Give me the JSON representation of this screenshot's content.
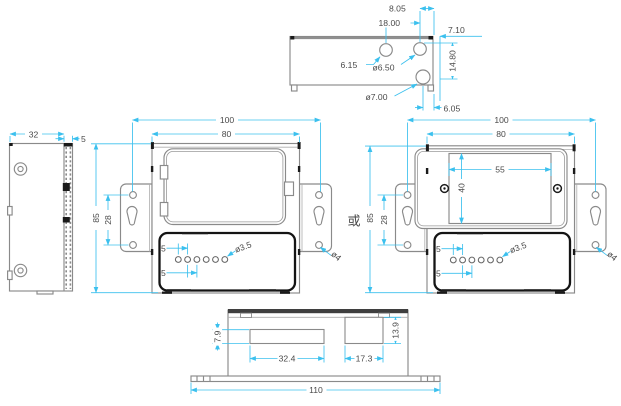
{
  "drawing": {
    "title": "enclosure-dimension-drawing",
    "colors": {
      "dimension_line": "#3bc0ee",
      "dimension_text": "#4a4a4a",
      "outline": "#8a8a8a",
      "feature_black": "#1a1a1a",
      "background": "#ffffff"
    },
    "views": {
      "top": {
        "dims": {
          "d1": "8.05",
          "d2": "18.00",
          "d3": "7.10",
          "d4": "6.15",
          "d5": "ø6.50",
          "d6": "14.80",
          "d7": "ø7.00",
          "d8": "6.05"
        }
      },
      "side": {
        "dims": {
          "width": "32",
          "flange": "5"
        }
      },
      "front_a": {
        "dims": {
          "mount_holes": "100",
          "body_width": "80",
          "height": "85",
          "ear_holes": "28",
          "pitch_a": "5",
          "pitch_b": "5",
          "small_hole": "ø3.5",
          "ear_hole": "ø4"
        }
      },
      "front_b": {
        "dims": {
          "mount_holes": "100",
          "body_width": "80",
          "window_width": "55",
          "window_height": "40",
          "height": "85",
          "ear_holes": "28",
          "pitch_a": "5",
          "pitch_b": "5",
          "small_hole": "ø3.5",
          "ear_hole": "ø4"
        }
      },
      "bottom": {
        "dims": {
          "slot1_height": "7.9",
          "slot1_width": "32.4",
          "slot2_width": "17.3",
          "slot2_height": "13.9",
          "overall_width": "110"
        }
      },
      "separator_label": "或"
    }
  }
}
